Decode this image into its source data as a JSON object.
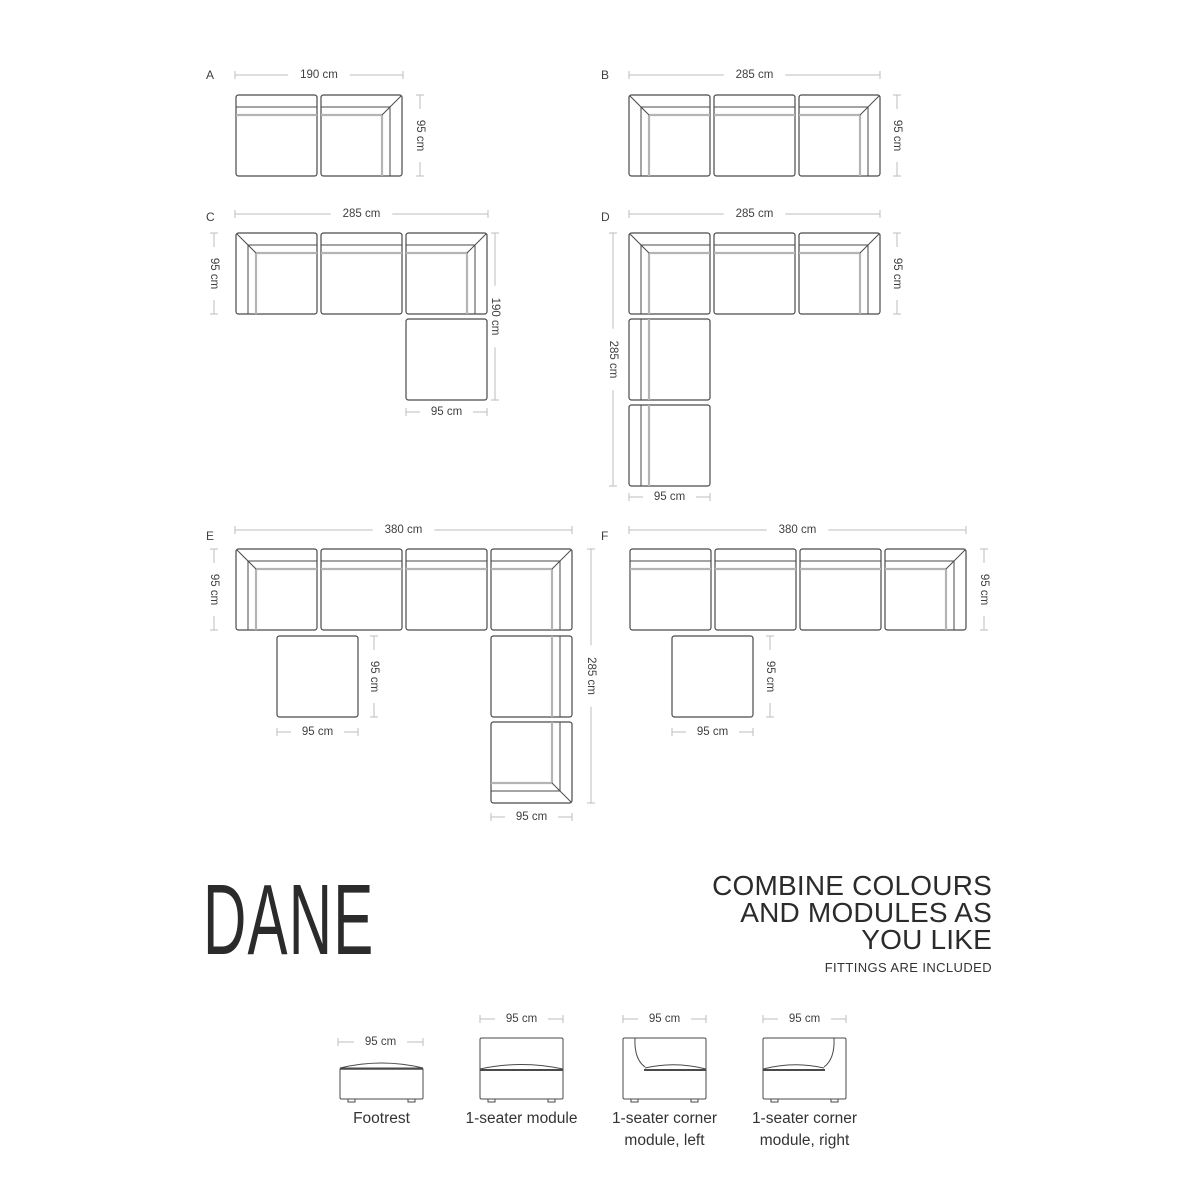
{
  "title": {
    "name": "DANE"
  },
  "tagline": {
    "line1": "COMBINE COLOURS",
    "line2": "AND MODULES AS",
    "line3": "YOU LIKE",
    "note": "FITTINGS ARE INCLUDED"
  },
  "colors": {
    "outline": "#4a4a4a",
    "band_light": "#b4b4b4",
    "dim_line": "#bdbdbd",
    "dim_text": "#3f3f3f"
  },
  "configurations": [
    {
      "label": "A",
      "label_pos": [
        206,
        79
      ],
      "modules": [
        {
          "x": 236,
          "y": 95,
          "w": 81,
          "h": 81,
          "type": "seat-top"
        },
        {
          "x": 321,
          "y": 95,
          "w": 81,
          "h": 81,
          "type": "corner-tr"
        }
      ],
      "dims": [
        {
          "dir": "h",
          "x1": 235,
          "x2": 403,
          "y": 75,
          "label": "190 cm"
        },
        {
          "dir": "v",
          "x": 420,
          "y1": 95,
          "y2": 176,
          "label": "95 cm"
        }
      ]
    },
    {
      "label": "B",
      "label_pos": [
        601,
        79
      ],
      "modules": [
        {
          "x": 629,
          "y": 95,
          "w": 81,
          "h": 81,
          "type": "corner-tl"
        },
        {
          "x": 714,
          "y": 95,
          "w": 81,
          "h": 81,
          "type": "seat-top"
        },
        {
          "x": 799,
          "y": 95,
          "w": 81,
          "h": 81,
          "type": "corner-tr"
        }
      ],
      "dims": [
        {
          "dir": "h",
          "x1": 629,
          "x2": 880,
          "y": 75,
          "label": "285 cm"
        },
        {
          "dir": "v",
          "x": 897,
          "y1": 95,
          "y2": 176,
          "label": "95 cm"
        }
      ]
    },
    {
      "label": "C",
      "label_pos": [
        206,
        221
      ],
      "modules": [
        {
          "x": 236,
          "y": 233,
          "w": 81,
          "h": 81,
          "type": "corner-tl"
        },
        {
          "x": 321,
          "y": 233,
          "w": 81,
          "h": 81,
          "type": "seat-top"
        },
        {
          "x": 406,
          "y": 233,
          "w": 81,
          "h": 81,
          "type": "corner-tr"
        },
        {
          "x": 406,
          "y": 319,
          "w": 81,
          "h": 81,
          "type": "footrest"
        }
      ],
      "dims": [
        {
          "dir": "h",
          "x1": 235,
          "x2": 488,
          "y": 214,
          "label": "285 cm"
        },
        {
          "dir": "v",
          "x": 214,
          "y1": 233,
          "y2": 314,
          "label": "95 cm"
        },
        {
          "dir": "v",
          "x": 495,
          "y1": 233,
          "y2": 400,
          "label": "190 cm"
        },
        {
          "dir": "h",
          "x1": 406,
          "x2": 487,
          "y": 412,
          "label": "95 cm"
        }
      ]
    },
    {
      "label": "D",
      "label_pos": [
        601,
        221
      ],
      "modules": [
        {
          "x": 629,
          "y": 233,
          "w": 81,
          "h": 81,
          "type": "corner-tl"
        },
        {
          "x": 714,
          "y": 233,
          "w": 81,
          "h": 81,
          "type": "seat-top"
        },
        {
          "x": 799,
          "y": 233,
          "w": 81,
          "h": 81,
          "type": "corner-tr"
        },
        {
          "x": 629,
          "y": 319,
          "w": 81,
          "h": 81,
          "type": "seat-left"
        },
        {
          "x": 629,
          "y": 405,
          "w": 81,
          "h": 81,
          "type": "seat-left"
        }
      ],
      "dims": [
        {
          "dir": "h",
          "x1": 629,
          "x2": 880,
          "y": 214,
          "label": "285 cm"
        },
        {
          "dir": "v",
          "x": 613,
          "y1": 233,
          "y2": 486,
          "label": "285 cm"
        },
        {
          "dir": "v",
          "x": 897,
          "y1": 233,
          "y2": 314,
          "label": "95 cm"
        },
        {
          "dir": "h",
          "x1": 629,
          "x2": 710,
          "y": 497,
          "label": "95 cm"
        }
      ]
    },
    {
      "label": "E",
      "label_pos": [
        206,
        540
      ],
      "modules": [
        {
          "x": 236,
          "y": 549,
          "w": 81,
          "h": 81,
          "type": "corner-tl"
        },
        {
          "x": 321,
          "y": 549,
          "w": 81,
          "h": 81,
          "type": "seat-top"
        },
        {
          "x": 406,
          "y": 549,
          "w": 81,
          "h": 81,
          "type": "seat-top"
        },
        {
          "x": 491,
          "y": 549,
          "w": 81,
          "h": 81,
          "type": "corner-tr"
        },
        {
          "x": 277,
          "y": 636,
          "w": 81,
          "h": 81,
          "type": "footrest"
        },
        {
          "x": 491,
          "y": 636,
          "w": 81,
          "h": 81,
          "type": "seat-right"
        },
        {
          "x": 491,
          "y": 722,
          "w": 81,
          "h": 81,
          "type": "corner-br"
        }
      ],
      "dims": [
        {
          "dir": "h",
          "x1": 235,
          "x2": 572,
          "y": 530,
          "label": "380 cm"
        },
        {
          "dir": "v",
          "x": 214,
          "y1": 549,
          "y2": 630,
          "label": "95 cm"
        },
        {
          "dir": "v",
          "x": 374,
          "y1": 636,
          "y2": 717,
          "label": "95 cm"
        },
        {
          "dir": "h",
          "x1": 277,
          "x2": 358,
          "y": 732,
          "label": "95 cm"
        },
        {
          "dir": "v",
          "x": 591,
          "y1": 549,
          "y2": 803,
          "label": "285 cm"
        },
        {
          "dir": "h",
          "x1": 491,
          "x2": 572,
          "y": 817,
          "label": "95 cm"
        }
      ]
    },
    {
      "label": "F",
      "label_pos": [
        601,
        540
      ],
      "modules": [
        {
          "x": 630,
          "y": 549,
          "w": 81,
          "h": 81,
          "type": "seat-top"
        },
        {
          "x": 715,
          "y": 549,
          "w": 81,
          "h": 81,
          "type": "seat-top"
        },
        {
          "x": 800,
          "y": 549,
          "w": 81,
          "h": 81,
          "type": "seat-top"
        },
        {
          "x": 885,
          "y": 549,
          "w": 81,
          "h": 81,
          "type": "corner-tr"
        },
        {
          "x": 672,
          "y": 636,
          "w": 81,
          "h": 81,
          "type": "footrest"
        }
      ],
      "dims": [
        {
          "dir": "h",
          "x1": 629,
          "x2": 966,
          "y": 530,
          "label": "380 cm"
        },
        {
          "dir": "v",
          "x": 984,
          "y1": 549,
          "y2": 630,
          "label": "95 cm"
        },
        {
          "dir": "v",
          "x": 770,
          "y1": 636,
          "y2": 717,
          "label": "95 cm"
        },
        {
          "dir": "h",
          "x1": 672,
          "x2": 753,
          "y": 732,
          "label": "95 cm"
        }
      ]
    }
  ],
  "legend": {
    "items": [
      {
        "type": "footrest-front",
        "x": 340,
        "w": 83,
        "label": "Footrest",
        "label2": "",
        "dim": {
          "x1": 338,
          "x2": 423,
          "y": 1042,
          "label": "95 cm"
        }
      },
      {
        "type": "seat-front",
        "x": 480,
        "w": 83,
        "label": "1-seater module",
        "label2": "",
        "dim": {
          "x1": 480,
          "x2": 563,
          "y": 1019,
          "label": "95 cm"
        }
      },
      {
        "type": "corner-left-front",
        "x": 623,
        "w": 83,
        "label": "1-seater corner",
        "label2": "module, left",
        "dim": {
          "x1": 623,
          "x2": 706,
          "y": 1019,
          "label": "95 cm"
        }
      },
      {
        "type": "corner-right-front",
        "x": 763,
        "w": 83,
        "label": "1-seater corner",
        "label2": "module, right",
        "dim": {
          "x1": 763,
          "x2": 846,
          "y": 1019,
          "label": "95 cm"
        }
      }
    ]
  }
}
